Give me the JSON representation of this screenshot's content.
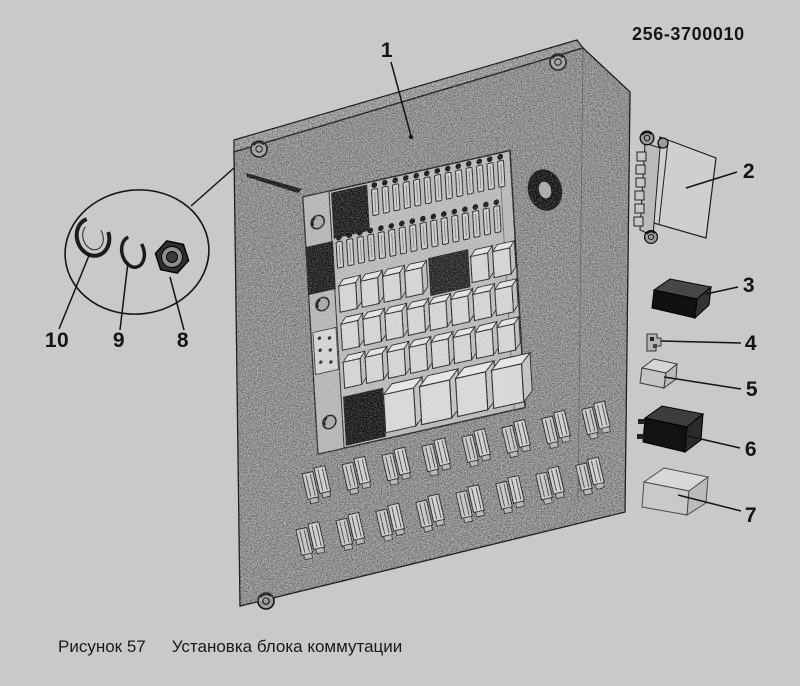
{
  "document": {
    "part_number": "256-3700010"
  },
  "figure": {
    "label": "Рисунок 57",
    "title": "Установка блока коммутации"
  },
  "callouts": [
    {
      "label": "1"
    },
    {
      "label": "2"
    },
    {
      "label": "3"
    },
    {
      "label": "4"
    },
    {
      "label": "5"
    },
    {
      "label": "6"
    },
    {
      "label": "7"
    },
    {
      "label": "8"
    },
    {
      "label": "9"
    },
    {
      "label": "10"
    }
  ],
  "colors": {
    "background": "#c9c9c9",
    "panel_base": "#a9a9a9",
    "ink": "#141414",
    "dark_part": "#161616",
    "light_part": "#d2d2d2"
  }
}
